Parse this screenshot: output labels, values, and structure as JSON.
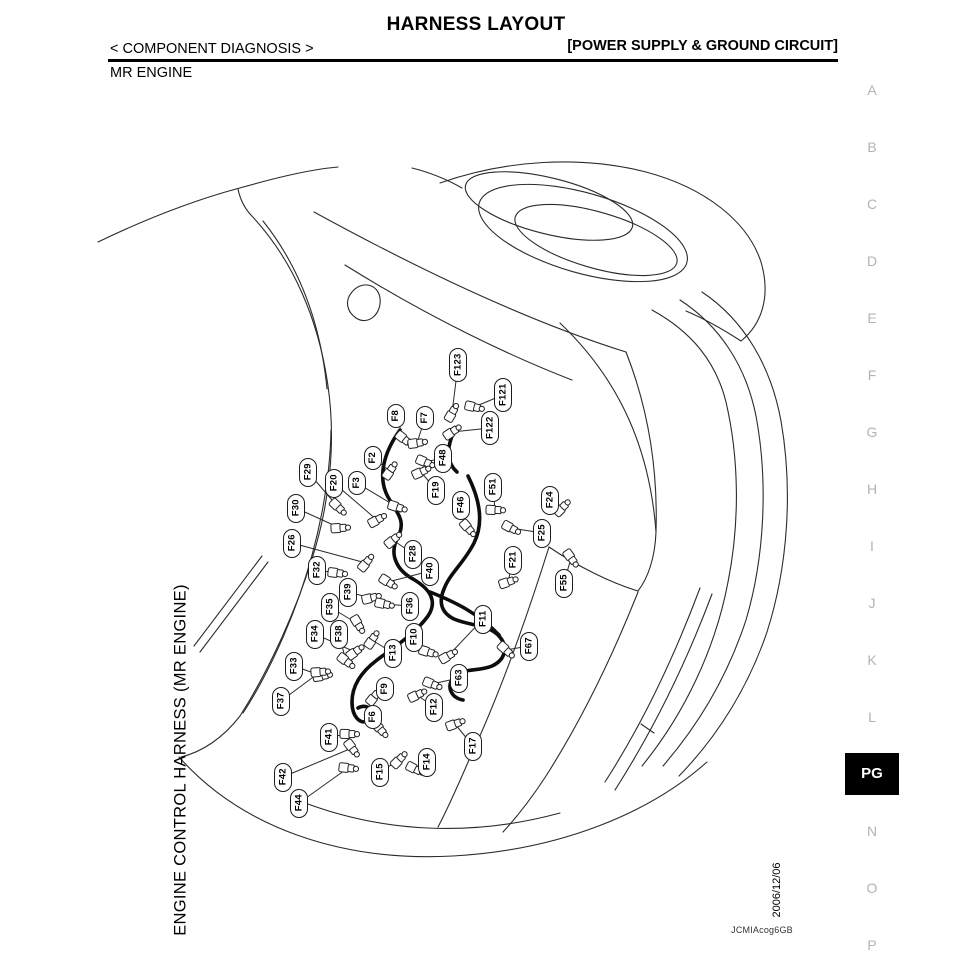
{
  "header": {
    "title": "HARNESS LAYOUT",
    "section": "< COMPONENT DIAGNOSIS >",
    "subsection": "[POWER SUPPLY & GROUND CIRCUIT]",
    "engine": "MR ENGINE"
  },
  "sidebar": {
    "active_bg": "#000000",
    "active_fg": "#ffffff",
    "inactive_fg": "#b3b3b3",
    "items": [
      {
        "label": "A"
      },
      {
        "label": "B"
      },
      {
        "label": "C"
      },
      {
        "label": "D"
      },
      {
        "label": "E"
      },
      {
        "label": "F"
      },
      {
        "label": "G"
      },
      {
        "label": "H"
      },
      {
        "label": "I"
      },
      {
        "label": "J"
      },
      {
        "label": "K"
      },
      {
        "label": "L"
      },
      {
        "label": "PG",
        "active": true
      },
      {
        "label": "N"
      },
      {
        "label": "O"
      },
      {
        "label": "P"
      }
    ]
  },
  "diagram": {
    "caption": "ENGINE CONTROL HARNESS (MR ENGINE)",
    "date": "2006/12/06",
    "figure_code": "JCMIAcog6GB",
    "connector_labels": [
      {
        "id": "F123",
        "lx": 458,
        "ly": 365,
        "cx": 452,
        "cy": 413
      },
      {
        "id": "F121",
        "lx": 503,
        "ly": 395,
        "cx": 474,
        "cy": 407
      },
      {
        "id": "F122",
        "lx": 490,
        "ly": 428,
        "cx": 452,
        "cy": 432
      },
      {
        "id": "F8",
        "lx": 396,
        "ly": 416,
        "cx": 404,
        "cy": 439
      },
      {
        "id": "F7",
        "lx": 425,
        "ly": 418,
        "cx": 417,
        "cy": 443
      },
      {
        "id": "F2",
        "lx": 373,
        "ly": 458,
        "cx": 390,
        "cy": 471
      },
      {
        "id": "F3",
        "lx": 357,
        "ly": 483,
        "cx": 397,
        "cy": 507
      },
      {
        "id": "F20",
        "lx": 334,
        "ly": 483,
        "cx": 377,
        "cy": 520
      },
      {
        "id": "F29",
        "lx": 308,
        "ly": 472,
        "cx": 338,
        "cy": 507
      },
      {
        "id": "F30",
        "lx": 296,
        "ly": 508,
        "cx": 340,
        "cy": 528
      },
      {
        "id": "F26",
        "lx": 292,
        "ly": 543,
        "cx": 366,
        "cy": 563
      },
      {
        "id": "F48",
        "lx": 443,
        "ly": 458,
        "cx": 425,
        "cy": 462
      },
      {
        "id": "F19",
        "lx": 436,
        "ly": 490,
        "cx": 421,
        "cy": 472
      },
      {
        "id": "F46",
        "lx": 461,
        "ly": 505,
        "cx": 468,
        "cy": 528
      },
      {
        "id": "F51",
        "lx": 493,
        "ly": 487,
        "cx": 495,
        "cy": 510
      },
      {
        "id": "F24",
        "lx": 550,
        "ly": 500,
        "cx": 562,
        "cy": 508
      },
      {
        "id": "F25",
        "lx": 542,
        "ly": 533,
        "cx": 511,
        "cy": 528
      },
      {
        "id": "F21",
        "lx": 513,
        "ly": 560,
        "cx": 508,
        "cy": 582
      },
      {
        "id": "F55",
        "lx": 564,
        "ly": 583,
        "cx": 571,
        "cy": 558
      },
      {
        "id": "F32",
        "lx": 317,
        "ly": 570,
        "cx": 337,
        "cy": 573
      },
      {
        "id": "F28",
        "lx": 413,
        "ly": 554,
        "cx": 393,
        "cy": 540
      },
      {
        "id": "F40",
        "lx": 430,
        "ly": 571,
        "cx": 388,
        "cy": 582
      },
      {
        "id": "F39",
        "lx": 348,
        "ly": 592,
        "cx": 371,
        "cy": 598
      },
      {
        "id": "F35",
        "lx": 330,
        "ly": 607,
        "cx": 358,
        "cy": 624
      },
      {
        "id": "F36",
        "lx": 410,
        "ly": 606,
        "cx": 384,
        "cy": 604
      },
      {
        "id": "F34",
        "lx": 315,
        "ly": 634,
        "cx": 355,
        "cy": 652
      },
      {
        "id": "F38",
        "lx": 339,
        "ly": 634,
        "cx": 346,
        "cy": 661
      },
      {
        "id": "F33",
        "lx": 294,
        "ly": 666,
        "cx": 322,
        "cy": 676
      },
      {
        "id": "F13",
        "lx": 393,
        "ly": 653,
        "cx": 372,
        "cy": 640
      },
      {
        "id": "F10",
        "lx": 414,
        "ly": 637,
        "cx": 428,
        "cy": 652
      },
      {
        "id": "F11",
        "lx": 483,
        "ly": 619,
        "cx": 448,
        "cy": 656
      },
      {
        "id": "F67",
        "lx": 529,
        "ly": 646,
        "cx": 506,
        "cy": 650
      },
      {
        "id": "F37",
        "lx": 281,
        "ly": 701,
        "cx": 320,
        "cy": 672
      },
      {
        "id": "F9",
        "lx": 385,
        "ly": 689,
        "cx": 374,
        "cy": 697
      },
      {
        "id": "F63",
        "lx": 459,
        "ly": 678,
        "cx": 432,
        "cy": 684
      },
      {
        "id": "F12",
        "lx": 434,
        "ly": 707,
        "cx": 417,
        "cy": 695
      },
      {
        "id": "F6",
        "lx": 373,
        "ly": 717,
        "cx": 380,
        "cy": 729
      },
      {
        "id": "F41",
        "lx": 329,
        "ly": 737,
        "cx": 349,
        "cy": 734
      },
      {
        "id": "F15",
        "lx": 380,
        "ly": 772,
        "cx": 399,
        "cy": 760
      },
      {
        "id": "F14",
        "lx": 427,
        "ly": 762,
        "cx": 415,
        "cy": 769
      },
      {
        "id": "F17",
        "lx": 473,
        "ly": 746,
        "cx": 455,
        "cy": 724
      },
      {
        "id": "F42",
        "lx": 283,
        "ly": 777,
        "cx": 352,
        "cy": 748
      },
      {
        "id": "F44",
        "lx": 299,
        "ly": 803,
        "cx": 348,
        "cy": 768
      }
    ]
  }
}
